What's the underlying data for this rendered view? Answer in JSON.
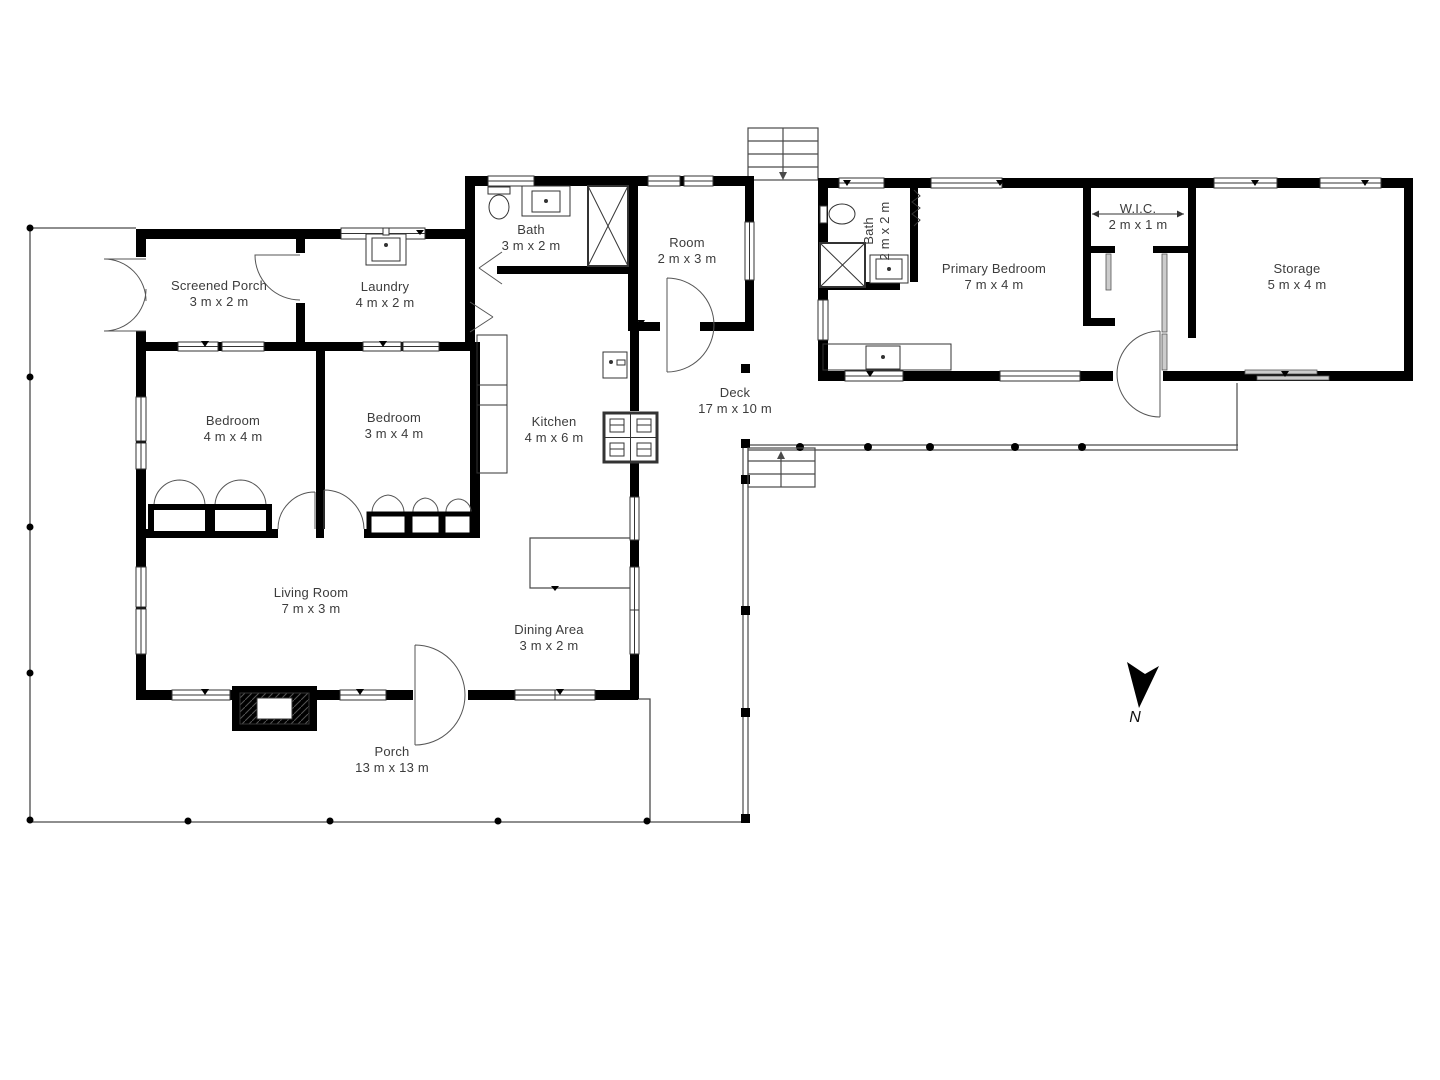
{
  "app": {
    "type": "floor-plan-viewer",
    "background": "#ffffff"
  },
  "plan": {
    "north_label": "N",
    "rooms": [
      {
        "id": "screened-porch",
        "name": "Screened Porch",
        "dims": "3 m x 2 m"
      },
      {
        "id": "laundry",
        "name": "Laundry",
        "dims": "4 m x 2 m"
      },
      {
        "id": "bath-main",
        "name": "Bath",
        "dims": "3 m x 2 m"
      },
      {
        "id": "room",
        "name": "Room",
        "dims": "2 m x 3 m"
      },
      {
        "id": "bath-primary",
        "name": "Bath",
        "dims": "2 m x 2 m"
      },
      {
        "id": "primary-bedroom",
        "name": "Primary Bedroom",
        "dims": "7 m x 4 m"
      },
      {
        "id": "wic",
        "name": "W.I.C.",
        "dims": "2 m x 1 m"
      },
      {
        "id": "storage",
        "name": "Storage",
        "dims": "5 m x 4 m"
      },
      {
        "id": "bedroom-1",
        "name": "Bedroom",
        "dims": "4 m x 4 m"
      },
      {
        "id": "bedroom-2",
        "name": "Bedroom",
        "dims": "3 m x 4 m"
      },
      {
        "id": "kitchen",
        "name": "Kitchen",
        "dims": "4 m x 6 m"
      },
      {
        "id": "deck",
        "name": "Deck",
        "dims": "17 m x 10 m"
      },
      {
        "id": "living-room",
        "name": "Living Room",
        "dims": "7 m x 3 m"
      },
      {
        "id": "dining-area",
        "name": "Dining Area",
        "dims": "3 m x 2 m"
      },
      {
        "id": "porch",
        "name": "Porch",
        "dims": "13 m x 13 m"
      }
    ],
    "colors": {
      "wall": "#000000",
      "thin_line": "#4a4a4a",
      "text": "#3c3c3c",
      "background": "#ffffff"
    }
  }
}
